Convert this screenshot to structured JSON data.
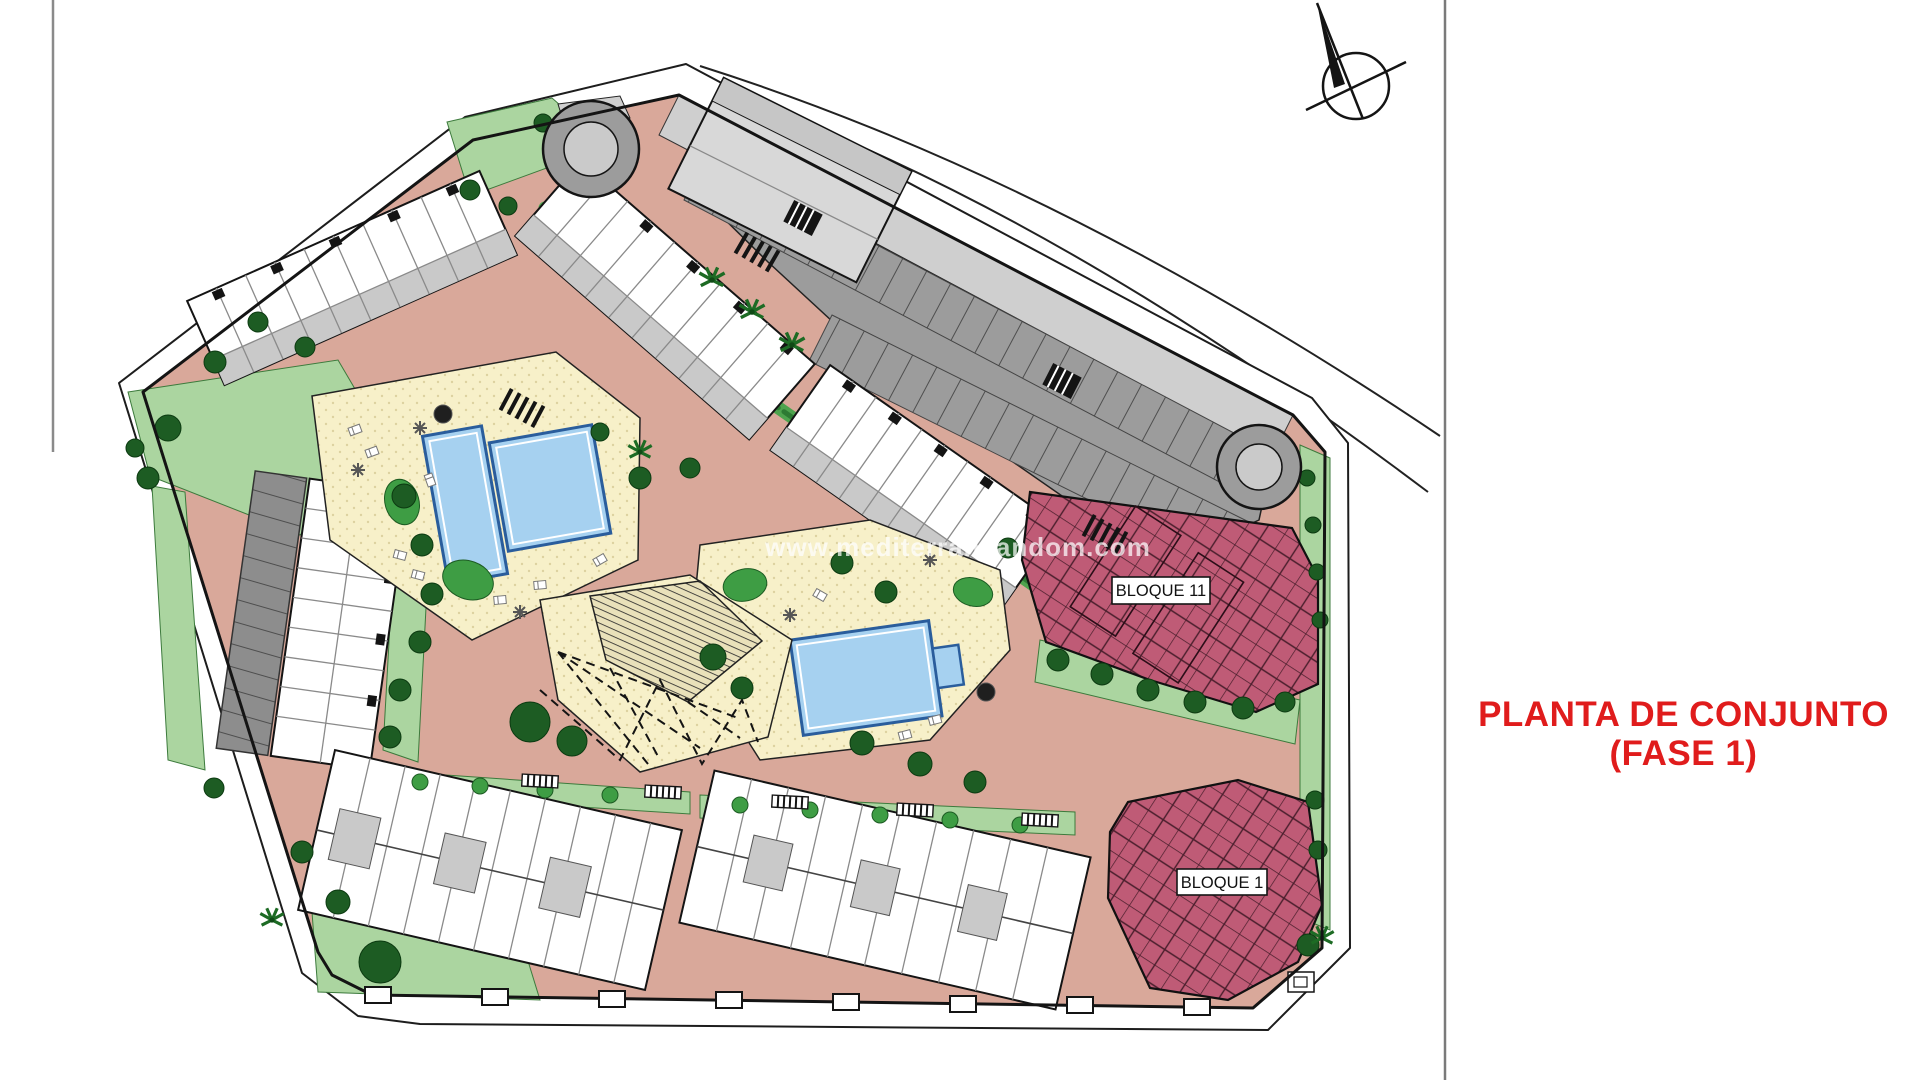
{
  "title_block": {
    "line1": "PLANTA DE CONJUNTO",
    "line2": "(FASE 1)"
  },
  "plan": {
    "building_labels": [
      {
        "id": "bloque-11",
        "text": "BLOQUE 11"
      },
      {
        "id": "bloque-1",
        "text": "BLOQUE 1"
      }
    ],
    "watermark": "www.mediterraneandom.com",
    "icons": {
      "north_arrow": "north-arrow-compass"
    },
    "palette": {
      "road_salmon": "#d9a89a",
      "road_light": "#cfcfcf",
      "parking_gray": "#9c9c9c",
      "green_light": "#abd5a0",
      "green_mid": "#4ea34e",
      "tree_dark": "#1d5c23",
      "deck_cream": "#f7f0c9",
      "pool_blue": "#a6d1f0",
      "pool_edge": "#2a5d9c",
      "building_white": "#ffffff",
      "building_gray": "#c9c9c9",
      "dark_gray": "#8d8d8d",
      "maroon": "#bf5b76",
      "line_black": "#1a1a1a",
      "title_red": "#e01c1c"
    }
  }
}
